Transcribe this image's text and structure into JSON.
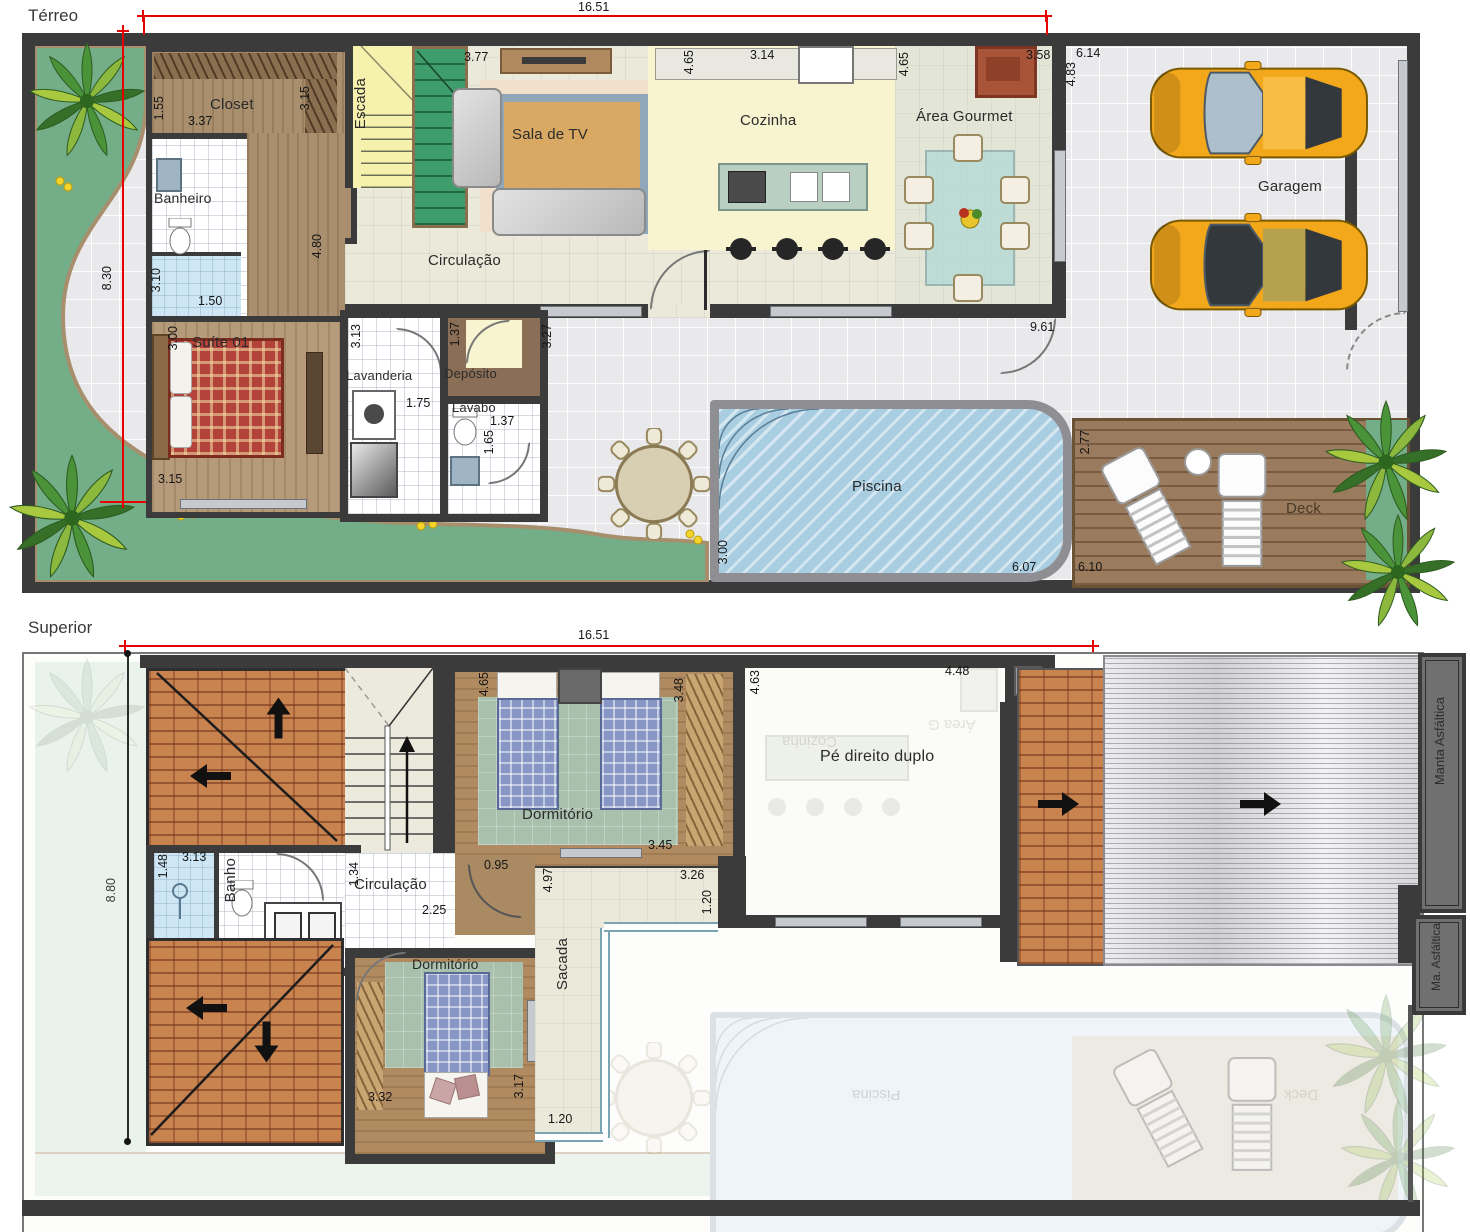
{
  "terreo": {
    "title": "Térreo",
    "rooms": {
      "closet": "Closet",
      "banheiro": "Banheiro",
      "escada": "Escada",
      "sala_tv": "Sala de TV",
      "circulacao": "Circulação",
      "cozinha": "Cozinha",
      "area_gourmet": "Área Gourmet",
      "garagem": "Garagem",
      "suite": "Suíte 01",
      "lavanderia": "Lavanderia",
      "deposito": "Depósito",
      "lavabo": "Lavabo",
      "piscina": "Piscina",
      "deck": "Deck"
    },
    "dims": {
      "total_w": "16.51",
      "total_h": "8.30",
      "tv_wall": "3.77",
      "cozinha_h": "4.65",
      "cozinha_w": "3.14",
      "gourmet_h": "4.65",
      "gourmet_w": "3.58",
      "garagem_w": "6.14",
      "garagem_h": "4.83",
      "closet_d": "1.55",
      "closet_w": "3.37",
      "closet_h": "3.15",
      "banheiro_h": "3.10",
      "banheiro_w": "1.50",
      "hall_h": "4.80",
      "suite_h": "3.00",
      "suite_w": "3.15",
      "lavanderia_h": "3.13",
      "lavanderia_w": "1.75",
      "deposito_w": "1.37",
      "lavabo_w": "1.37",
      "lavabo_h": "1.65",
      "varanda_h": "3.27",
      "living_w": "9.61",
      "piscina_h": "3.00",
      "piscina_w": "6.07",
      "deck_h": "2.77",
      "deck_w": "6.10"
    }
  },
  "superior": {
    "title": "Superior",
    "rooms": {
      "dormitorio1": "Dormitório",
      "dormitorio2": "Dormitório",
      "banho": "Banho",
      "circulacao": "Circulação",
      "pe_direito": "Pé direito duplo",
      "sacada": "Sacada",
      "manta": "Manta Asfáltica",
      "manta_abbr": "Ma. Asfáltica"
    },
    "ghost": {
      "cozinha": "Cozinha",
      "area_gourmet": "Área G",
      "piscina": "Piscina",
      "deck": "Deck"
    },
    "dims": {
      "total_w": "16.51",
      "total_h": "8.80",
      "dorm1_h": "4.65",
      "dorm1_ward": "3.48",
      "dorm1_w": "3.45",
      "dorm1_door": "0.95",
      "pe_h": "4.63",
      "pe_w": "4.48",
      "banho_d": "1.48",
      "banho_w": "3.13",
      "circ_h": "1.34",
      "circ_w": "2.25",
      "dorm2_w": "3.32",
      "dorm2_h": "3.17",
      "sacada_h": "4.97",
      "sacada_w": "3.26",
      "sacada_top": "1.20",
      "sacada_bot": "1.20"
    }
  }
}
